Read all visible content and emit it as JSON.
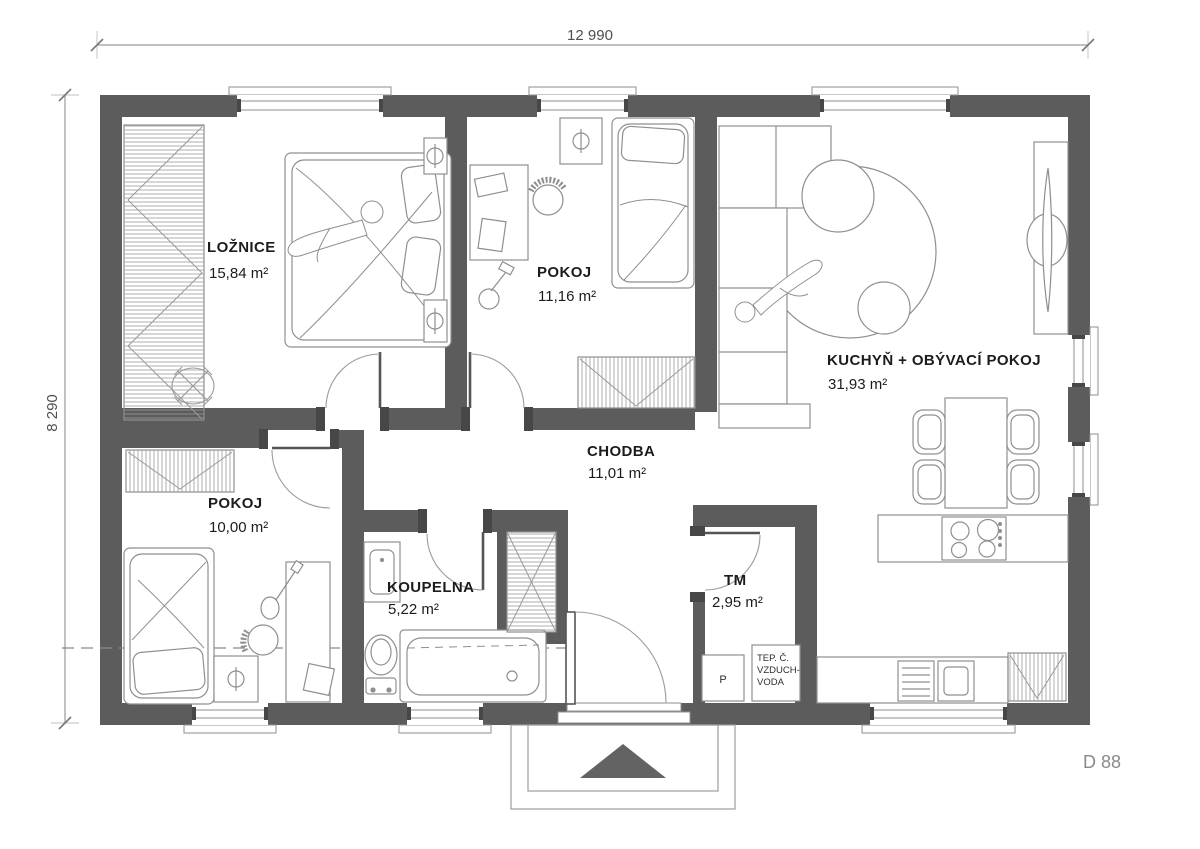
{
  "plan": {
    "dim_width": "12 990",
    "dim_height": "8 290",
    "drawing_number": "D 88",
    "rooms": [
      {
        "name": "LOŽNICE",
        "area": "15,84 m²"
      },
      {
        "name": "POKOJ",
        "area": "11,16 m²"
      },
      {
        "name": "KUCHYŇ + OBÝVACÍ POKOJ",
        "area": "31,93 m²"
      },
      {
        "name": "CHODBA",
        "area": "11,01 m²"
      },
      {
        "name": "POKOJ",
        "area": "10,00 m²"
      },
      {
        "name": "KOUPELNA",
        "area": "5,22 m²"
      },
      {
        "name": "TM",
        "area": "2,95 m²"
      }
    ],
    "tm_boxes": {
      "p": "P",
      "unit_line1": "TEP. Č.",
      "unit_line2": "VZDUCH-",
      "unit_line3": "VODA"
    },
    "colors": {
      "wall": "#5c5c5c",
      "furniture_line": "#8f8f8f",
      "dim_line": "#9a9a9a",
      "arrow": "#636363"
    }
  }
}
